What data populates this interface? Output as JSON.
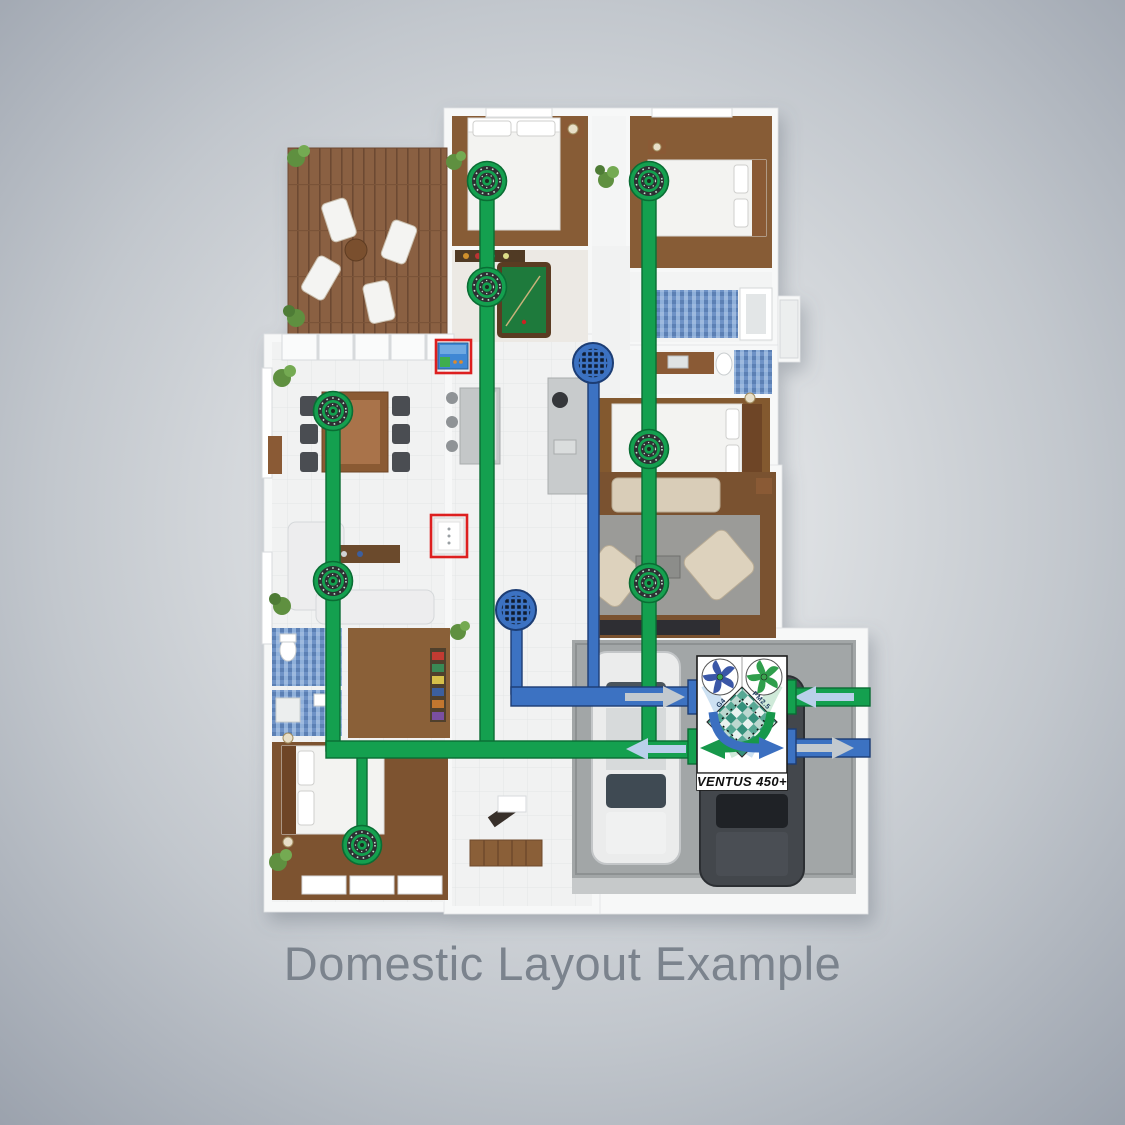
{
  "title": "Domestic Layout Example",
  "unit": {
    "label": "VENTUS 450+",
    "filter_left_label": "G4",
    "filter_right_label": "PM2.5",
    "x": 697,
    "y": 656,
    "width": 90,
    "height": 134
  },
  "colors": {
    "supply_green": "#14a04f",
    "supply_green_dark": "#0a6d34",
    "extract_blue": "#3c72c2",
    "extract_blue_dark": "#1c3d74",
    "arrow_light_blue": "#b9d0ea",
    "arrow_gray": "#c2c9cf",
    "highlight_red": "#dd1f1f",
    "title_gray": "#7b838d"
  },
  "vent": {
    "supply_diffusers": [
      {
        "x": 487,
        "y": 181
      },
      {
        "x": 649,
        "y": 181
      },
      {
        "x": 487,
        "y": 287
      },
      {
        "x": 333,
        "y": 411
      },
      {
        "x": 333,
        "y": 581
      },
      {
        "x": 649,
        "y": 449
      },
      {
        "x": 649,
        "y": 583
      },
      {
        "x": 362,
        "y": 845
      }
    ],
    "extract_grilles": [
      {
        "x": 593,
        "y": 363
      },
      {
        "x": 516,
        "y": 610
      }
    ],
    "supply_ducts": [
      {
        "x": 480,
        "y": 181,
        "w": 14,
        "h": 568
      },
      {
        "x": 642,
        "y": 181,
        "w": 14,
        "h": 568
      },
      {
        "x": 326,
        "y": 411,
        "w": 14,
        "h": 340
      },
      {
        "x": 357,
        "y": 745,
        "w": 10,
        "h": 100
      },
      {
        "x": 326,
        "y": 741,
        "w": 372,
        "h": 17
      },
      {
        "x": 786,
        "y": 688,
        "w": 84,
        "h": 18
      }
    ],
    "extract_ducts": [
      {
        "x": 588,
        "y": 363,
        "w": 11,
        "h": 330
      },
      {
        "x": 511,
        "y": 610,
        "w": 11,
        "h": 84
      },
      {
        "x": 511,
        "y": 687,
        "w": 187,
        "h": 19
      },
      {
        "x": 786,
        "y": 739,
        "w": 84,
        "h": 18
      }
    ],
    "flow_arrows": [
      {
        "cx": 655,
        "cy": 697,
        "dir": "right",
        "color": "gray"
      },
      {
        "cx": 656,
        "cy": 749,
        "dir": "left",
        "color": "lightblue"
      },
      {
        "cx": 824,
        "cy": 697,
        "dir": "left",
        "color": "lightblue"
      },
      {
        "cx": 824,
        "cy": 748,
        "dir": "right",
        "color": "gray"
      }
    ],
    "highlight_boxes": [
      {
        "x": 436,
        "y": 340,
        "w": 35,
        "h": 33,
        "name": "wall-controller-highlight"
      },
      {
        "x": 431,
        "y": 515,
        "w": 36,
        "h": 42,
        "name": "wall-switch-highlight"
      }
    ]
  }
}
